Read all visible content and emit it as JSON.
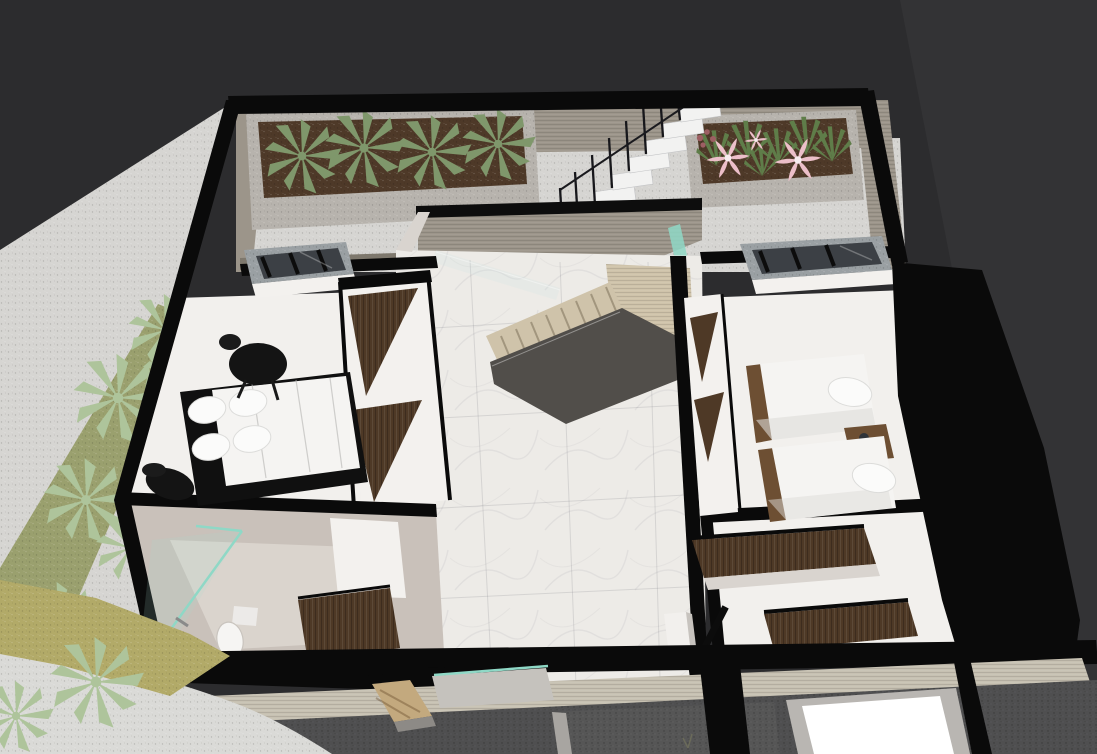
{
  "meta": {
    "title": "3D architectural floor plan render — upper storey cutaway",
    "view": "isometric-top-down-render",
    "visible_text": "none"
  },
  "scene": {
    "rooms": [
      {
        "id": "terrace-garden",
        "label": "roof terrace with fern planter and lily bed"
      },
      {
        "id": "exterior-stair",
        "label": "white cantilever stair with balusters"
      },
      {
        "id": "hallway",
        "label": "central hall with wood staircase"
      },
      {
        "id": "bedroom-left",
        "label": "bedroom with double bed"
      },
      {
        "id": "bedroom-right",
        "label": "bedroom with twin beds"
      },
      {
        "id": "bathroom",
        "label": "bathroom with glass shower and toilet"
      },
      {
        "id": "closet-room",
        "label": "walk-in closet with wood shelving"
      },
      {
        "id": "exterior-garden",
        "label": "side garden strip with ferns"
      },
      {
        "id": "light-wells",
        "label": "lower-floor openings at bottom edge"
      }
    ]
  },
  "colors": {
    "background": "#2c2c2e",
    "background_light": "#39393b",
    "wall_black": "#0a0a0a",
    "slab_trim": "#0d0d0d",
    "concrete_wood_wall": "#9c958a",
    "concrete_wall_shadow": "#7e786d",
    "planter_stone": "#b7b3ad",
    "soil": "#4e3928",
    "fern_green": "#7f976b",
    "fern_light": "#aec49b",
    "grass_plant": "#5f7d49",
    "lily_pink": "#ecbfc9",
    "lily_bud": "#9d5f63",
    "paving_exterior": "#d6d5d2",
    "gravel_strip": "#9aa06e",
    "lawn": "#b2aa68",
    "concrete_path": "#dadad7",
    "marble_floor": "#edebe7",
    "marble_bright": "#f2f0ed",
    "wall_white": "#f3f1ee",
    "wall_shadow": "#d9d4cf",
    "bathroom_taupe": "#c9c1ba",
    "bathroom_floor": "#dad4cd",
    "wood_dark": "#4e3926",
    "wood_mid": "#6d4f33",
    "wood_light": "#cfc3aa",
    "wood_step": "#c3a97e",
    "stair_white": "#f2f2f1",
    "stair_stringer": "#514e4a",
    "glass_dark": "#3c4045",
    "glass_teal": "#8fd8c6",
    "window_sill": "#9aa0a3",
    "ground_dark": "#4f4f50",
    "carpet_dark": "#565656",
    "opening_glow": "#ffffff",
    "opening_face": "#b9b6b2",
    "inner_face_gray": "#a8a5a1",
    "linen_white": "#f5f4f2",
    "linen_shadow": "#dedcd8",
    "frame_black": "#101010",
    "furniture_black": "#141414",
    "door_black": "#0c0c0c",
    "greige_edge": "#c7c1b2",
    "stone_step": "#c5c2bd",
    "toilet_white": "#f6f5f3",
    "pillow_white": "#fbfbfa"
  }
}
